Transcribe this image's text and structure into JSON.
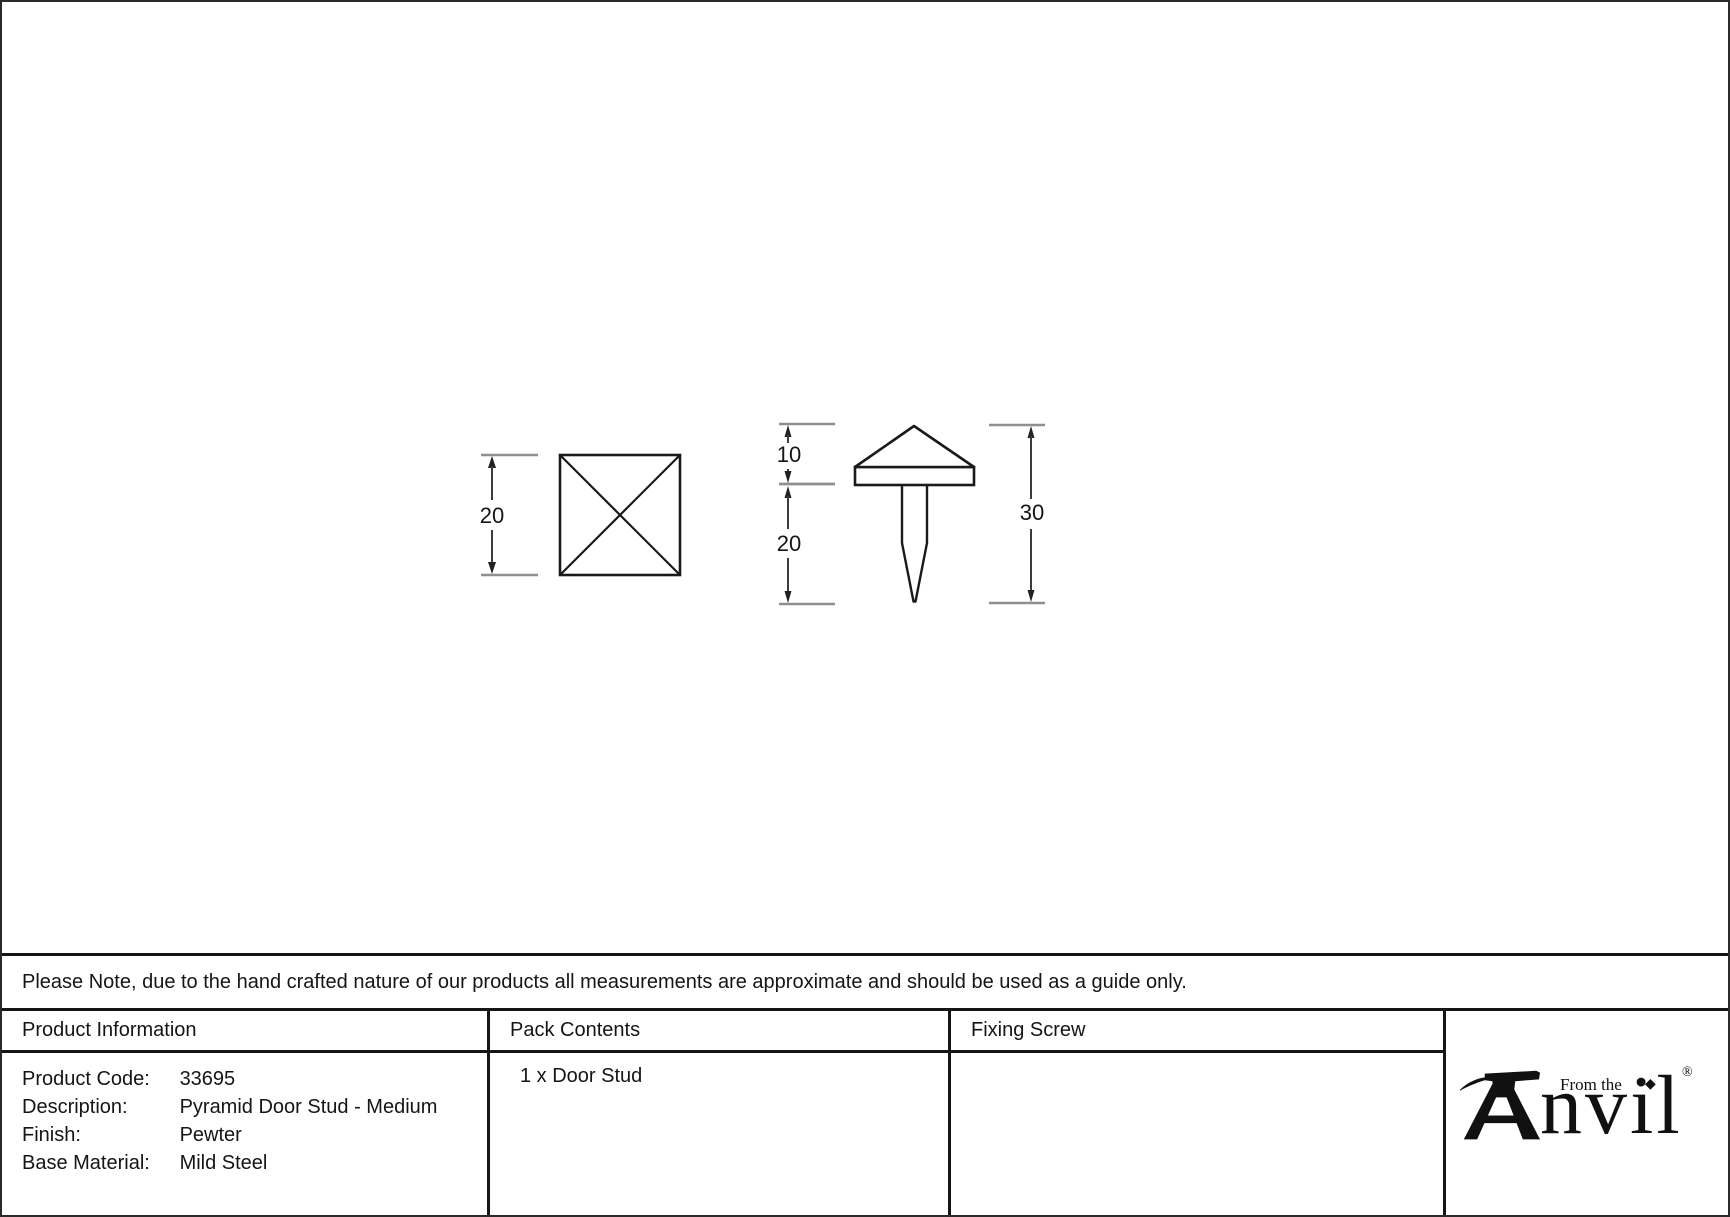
{
  "note": "Please Note, due to the hand crafted nature of our products all measurements are approximate and should be used as a guide only.",
  "drawing": {
    "top_view": {
      "name": "pyramid stud top view (square with diagonals)",
      "size_label": "20"
    },
    "side_view": {
      "name": "pyramid stud side view (head, base plate and fixing pin)",
      "head_height_label": "10",
      "pin_length_label": "20",
      "total_height_label": "30"
    }
  },
  "table": {
    "headers": {
      "product_information": "Product Information",
      "pack_contents": "Pack Contents",
      "fixing_screw": "Fixing Screw"
    },
    "product_information": {
      "rows": [
        {
          "label": "Product Code:",
          "value": "33695"
        },
        {
          "label": "Description:",
          "value": "Pyramid Door Stud - Medium"
        },
        {
          "label": "Finish:",
          "value": "Pewter"
        },
        {
          "label": "Base Material:",
          "value": "Mild Steel"
        }
      ]
    },
    "pack_contents": {
      "value": "1 x Door Stud"
    },
    "fixing_screw": {
      "value": ""
    }
  },
  "logo": {
    "icon": "anvil-icon",
    "from_the": "From the",
    "diamond": "◆",
    "wordmark_tail": "nvil",
    "registered": "®"
  },
  "colors": {
    "ink": "#1a1a1a",
    "dimension_line": "#3c3c3c",
    "extension_tick": "#8f8f8f",
    "background": "#ffffff"
  }
}
